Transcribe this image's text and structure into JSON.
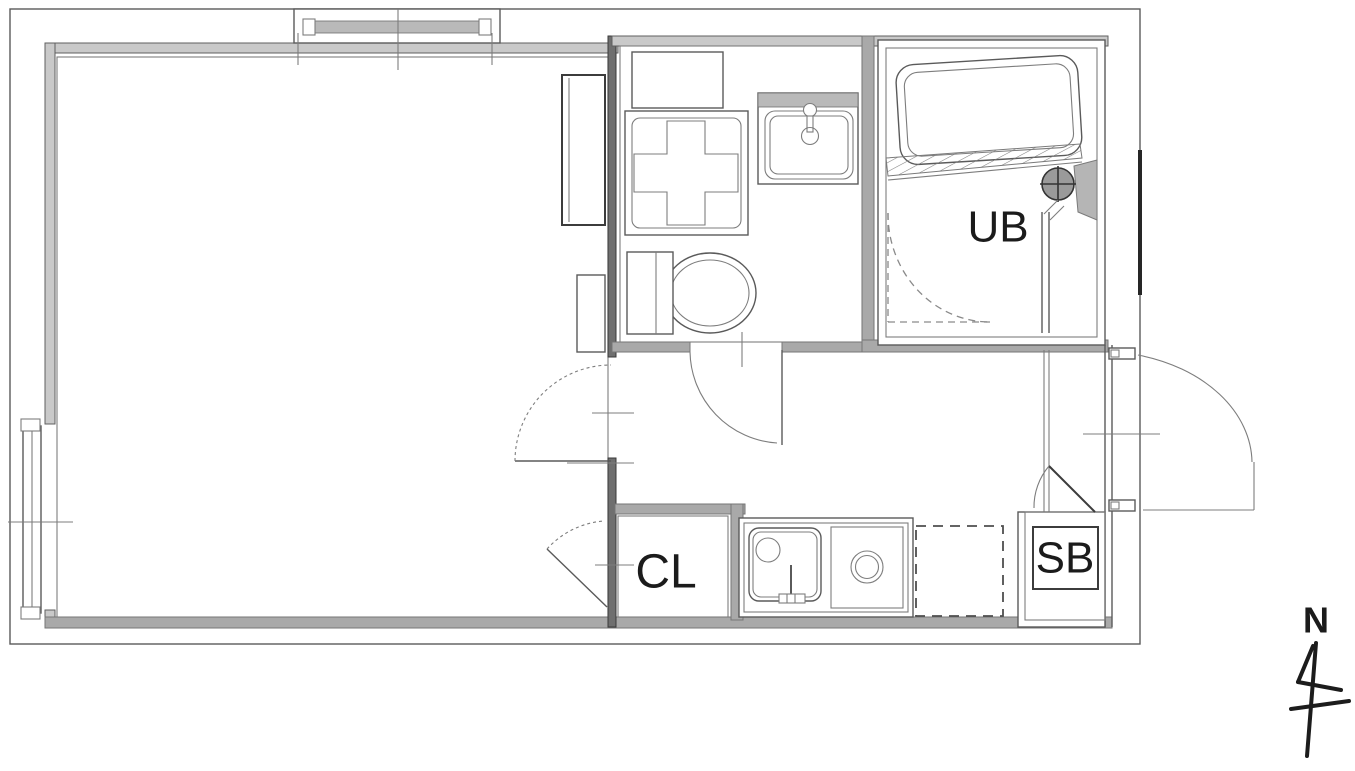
{
  "floor_plan": {
    "labels": {
      "unit_bath": "UB",
      "closet": "CL",
      "shoe_box": "SB",
      "north": "N"
    },
    "colors": {
      "background": "#ffffff",
      "line_dark": "#3c3c3c",
      "line_mid": "#6e6e6e",
      "wall_fill": "#a9a9a9",
      "glass_fill": "#b9b9b9",
      "text": "#1b1b1b"
    }
  }
}
